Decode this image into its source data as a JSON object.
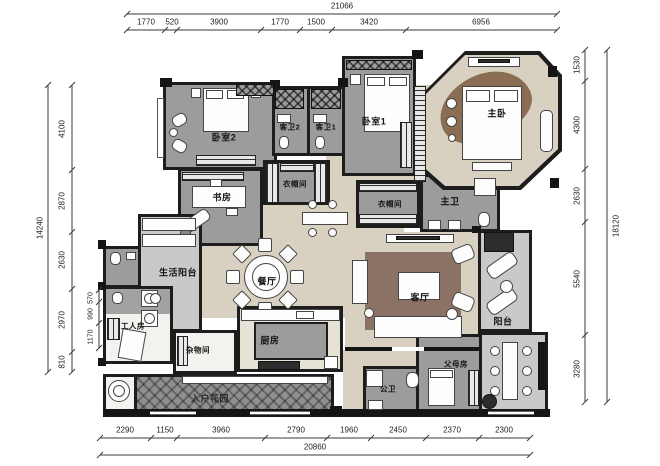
{
  "rooms": {
    "bedroom2": "卧室2",
    "guest_bath2": "客卫2",
    "guest_bath1": "客卫1",
    "bedroom1": "卧室1",
    "master_bedroom": "主卧",
    "study": "书房",
    "closet_left": "衣帽间",
    "closet_right": "衣帽间",
    "master_bath": "主卫",
    "dining": "餐厅",
    "living": "客厅",
    "balcony": "阳台",
    "service_balcony": "生活阳台",
    "maid_room": "工人房",
    "storage": "杂物间",
    "kitchen": "厨房",
    "public_bath": "公卫",
    "parents_room": "父母房",
    "entry_garden": "入户花园"
  },
  "dimensions": {
    "top": {
      "total": "21066",
      "segments": [
        "1770",
        "520",
        "3900",
        "1770",
        "1500",
        "3420",
        "6956"
      ]
    },
    "bottom": {
      "total": "20860",
      "segments": [
        "2290",
        "1150",
        "3960",
        "2790",
        "1960",
        "2450",
        "2370",
        "2300"
      ]
    },
    "left": {
      "total": "14240",
      "segments": [
        "4100",
        "2870",
        "2630",
        "2970",
        "810"
      ],
      "inner": [
        "570",
        "990",
        "1170"
      ]
    },
    "right": {
      "total": "18120",
      "segments": [
        "1530",
        "4300",
        "2630",
        "5540",
        "3280"
      ]
    }
  },
  "colors": {
    "wall": "#1d1d1d",
    "bedroom_floor": "#9c9c9c",
    "living_floor": "#d8d1c2",
    "balcony_floor": "#c9c9c9",
    "garden_floor": "#8f8f8f",
    "rug": "#8b7264"
  }
}
